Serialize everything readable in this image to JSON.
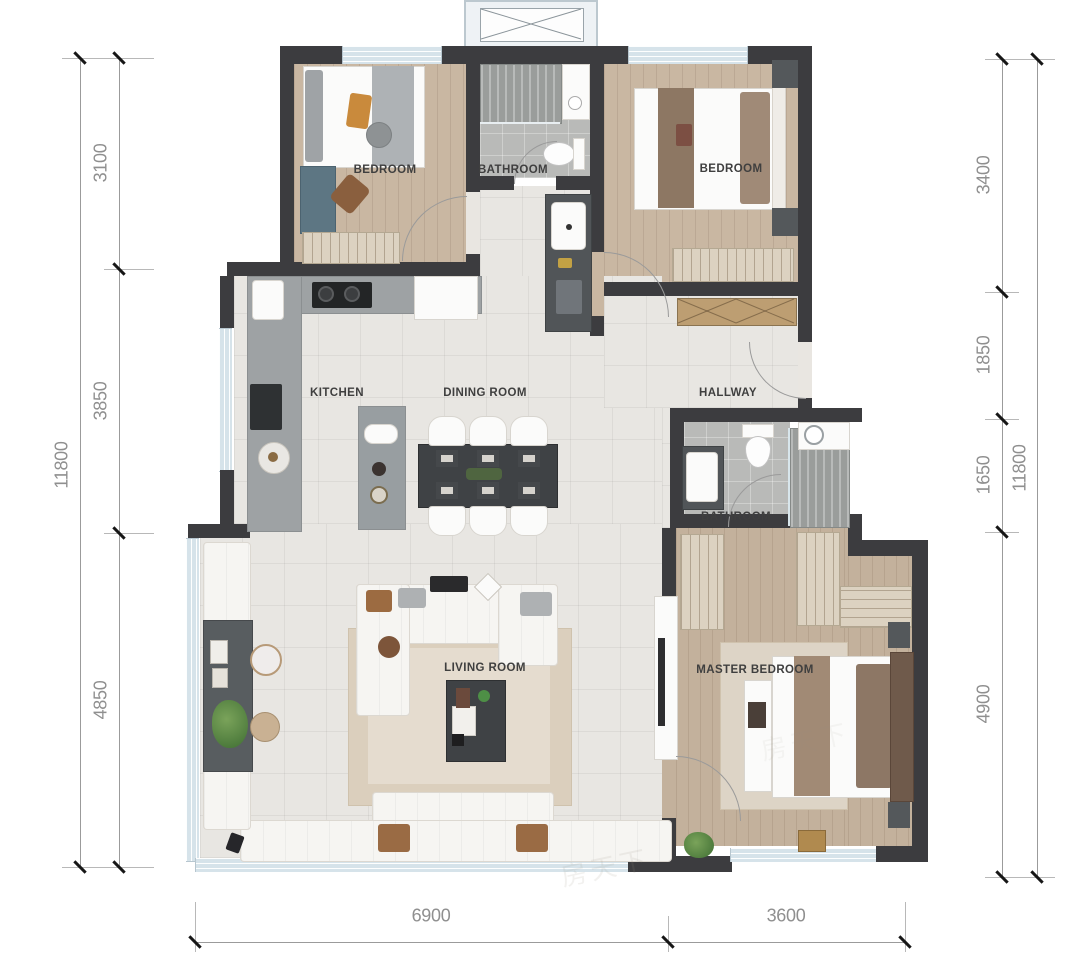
{
  "plan": {
    "rooms": [
      {
        "id": "bedroom-1",
        "label": "BEDROOM"
      },
      {
        "id": "bathroom-1",
        "label": "BATHROOM"
      },
      {
        "id": "bedroom-2",
        "label": "BEDROOM"
      },
      {
        "id": "kitchen",
        "label": "KITCHEN"
      },
      {
        "id": "dining-room",
        "label": "DINING ROOM"
      },
      {
        "id": "hallway",
        "label": "HALLWAY"
      },
      {
        "id": "bathroom-2",
        "label": "BATHROOM"
      },
      {
        "id": "living-room",
        "label": "LIVING ROOM"
      },
      {
        "id": "master-bedroom",
        "label": "MASTER BEDROOM"
      }
    ],
    "dimensions": {
      "left": {
        "total": "11800",
        "segments": [
          "3100",
          "3850",
          "4850"
        ]
      },
      "right": {
        "total": "11800",
        "segments": [
          "3400",
          "1850",
          "1650",
          "4900"
        ]
      },
      "bottom": {
        "segments": [
          "6900",
          "3600"
        ]
      }
    },
    "watermark": "房天下",
    "colors": {
      "wall": "#3c3c3f",
      "window": "#d6e3ea",
      "wood_floor": "#c9b7a2",
      "marble_floor": "#e8e6e2",
      "tile_floor": "#b9bab8",
      "dimension_text": "#8f8f8f",
      "room_label": "#3f3f3f"
    }
  }
}
